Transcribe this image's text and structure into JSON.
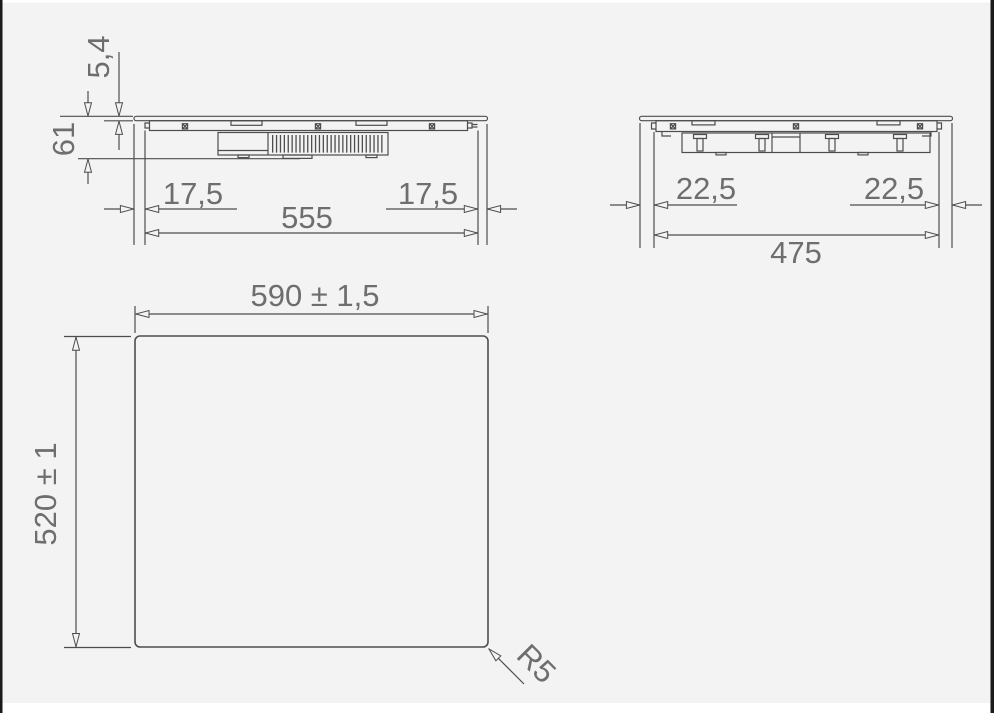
{
  "palette": {
    "background": "#f3f3f4",
    "linework": "#4d4d4d",
    "dimension_text": "#6e6e6e",
    "frame_side_bars": "#1a1a1a",
    "frame_top_bottom_bars": "#ffffff"
  },
  "front_view": {
    "description": "hob front elevation with mounting dimensions (mm)",
    "glass_thickness": "5,4",
    "overall_height": "61",
    "overhang_left": "17,5",
    "body_width": "555",
    "overhang_right": "17,5"
  },
  "side_view": {
    "description": "hob side elevation with mounting dimensions (mm)",
    "overhang_left": "22,5",
    "body_depth": "475",
    "overhang_right": "22,5"
  },
  "cutout_view": {
    "description": "worktop cutout plan dimensions (mm)",
    "cutout_width": "590 ± 1,5",
    "cutout_depth": "520 ± 1",
    "corner_radius": "R5"
  }
}
